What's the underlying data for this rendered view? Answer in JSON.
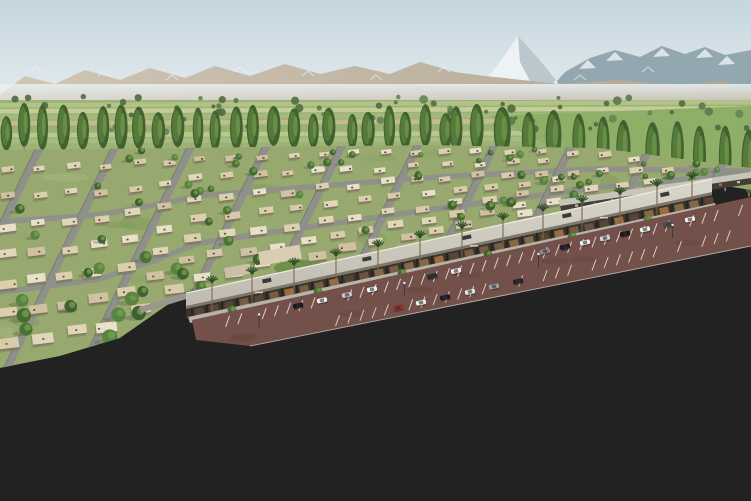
{
  "meta": {
    "title": "Aerial rendering of a master-planned desert community with retail strip",
    "type": "architectural-render",
    "visible_text": []
  },
  "palette": {
    "sky_top": "#c5d6df",
    "sky_bottom": "#e9eff1",
    "mountain_far": "#93a7b1",
    "mountain_far_shadow": "#7f939d",
    "snow": "#edf2f4",
    "mountain_near_light": "#d0c6b6",
    "mountain_near_dark": "#b3a693",
    "haze": "#e9f1f3",
    "field_base": "#9db275",
    "field_strips": [
      "#b4c48c",
      "#c6cf9b",
      "#a4ba7e",
      "#c9bd92",
      "#97b272",
      "#bec990",
      "#a9bd82"
    ],
    "field_bright": "#8fae67",
    "distant_tree": [
      "#5d7b4c",
      "#527044",
      "#67855350",
      "#4f6b42"
    ],
    "poplar_dark": "#426030",
    "poplar_mid": "#567a3a",
    "poplar_light": "#6b9448",
    "trunk": "#9a8a72",
    "lawn": "#97a96f",
    "lawn_var": [
      "#7f9a57",
      "#a8bb80",
      "#8aa263"
    ],
    "street": "#8f8f8b",
    "street_edge": "#63635f",
    "house_walls": [
      "#e2d6ba",
      "#d8cbac",
      "#cfc1a2",
      "#e8e0c8",
      "#dccfae"
    ],
    "house_shadow": "#6b604c",
    "house_opening": "#3a3228",
    "yard_tree": [
      "#3f6030",
      "#4c7038",
      "#5a8242",
      "#476b34"
    ],
    "canopy_light": "#d8d5cc",
    "canopy_dark": "#bfbbb0",
    "canopy_trim": "#eeeae0",
    "fascia": "#7d776c",
    "storefront_band": "#3a342c",
    "glass": [
      "#6a5542",
      "#7a6044",
      "#584836",
      "#8a6c4a",
      "#a0703f"
    ],
    "roof_unit": "#3c3a36",
    "walkway": "#b7b3a8",
    "palm_frond": "#35552a",
    "lot": "#73504a",
    "stall_line": "#eee8de",
    "car_colors": [
      "#f2f2ef",
      "#16161a",
      "#c8c9cb",
      "#4a4e55",
      "#962f28"
    ],
    "umbrella": "#d2662c",
    "island": "#8f8a66",
    "shrub": [
      "#6b7a4a",
      "#8a8a5a",
      "#5d6b42",
      "#b0a278"
    ],
    "road": "#9a9a95",
    "center_line": "#d9a73f",
    "lane_line": "#e3e3dd",
    "crosswalk": "#e2e2dc",
    "sidewalk": "#c8c6be",
    "verge": "#7d8a55",
    "grass": "#8b9157",
    "grass_var": [
      "#9aa36b",
      "#7b8750",
      "#a8ae77",
      "#6f7c49"
    ],
    "shadow_green": "#4c5a36",
    "road_shadow": "#6e6e68",
    "fg_tree_dark": "#3c5a28",
    "fg_tree_mid": "#49702f",
    "fg_tree_light2": "#567f36",
    "fg_tree_hi": [
      "#6f9c41",
      "#7fae4e"
    ],
    "fg_trunk": "#b3a286",
    "sign_red": "#a82f26",
    "sign_green": "#3c6f44"
  },
  "scene": {
    "snow_peak": {
      "x": 518,
      "apex_y": 36
    },
    "mid_poplars_left": {
      "count": 24,
      "x0": 6,
      "x1": 446,
      "base_y": 151,
      "h_min": 34,
      "h_max": 46
    },
    "mid_poplars_right": {
      "count": 13,
      "x0": 455,
      "x1": 748,
      "base_y0": 153,
      "base_y1": 196,
      "h0": 46,
      "h1": 64
    },
    "distant_trees": {
      "count": 70,
      "y0": 96,
      "y1": 132
    },
    "subdivision": {
      "cross_streets": 12,
      "house_rows": 7,
      "yard_trees": 80
    },
    "mall": {
      "x0": 186,
      "y0": 293,
      "x1": 712,
      "y1": 179,
      "slope": -0.2167,
      "palms_x": [
        212,
        252,
        294,
        336,
        378,
        420,
        462,
        503,
        543,
        582,
        620,
        657,
        692
      ],
      "planter_trees_x": [
        232,
        318,
        402,
        488,
        572,
        648
      ],
      "roof_units_x": [
        262,
        362,
        462,
        562,
        660
      ],
      "signs_x": [
        255,
        470,
        600
      ]
    },
    "cafe": {
      "x": 258,
      "y": 252
    },
    "umbrellas": [
      [
        158,
        297
      ],
      [
        171,
        301
      ],
      [
        185,
        307
      ],
      [
        198,
        301
      ],
      [
        207,
        309
      ],
      [
        177,
        313
      ]
    ],
    "plaza_people": [
      [
        162,
        303
      ],
      [
        180,
        309
      ],
      [
        196,
        306
      ],
      [
        208,
        313
      ],
      [
        152,
        300
      ]
    ],
    "walkway_people_x": [
      250,
      300,
      430,
      520,
      610
    ],
    "parking": {
      "row_a_cars": [
        {
          "x": 298,
          "c": "#16161a"
        },
        {
          "x": 322,
          "c": "#f2f2ef"
        },
        {
          "x": 347,
          "c": "#c8c9cb"
        },
        {
          "x": 372,
          "c": "#f4f4f1"
        },
        {
          "x": 432,
          "c": "#2a2c30"
        },
        {
          "x": 456,
          "c": "#f1f1ee"
        },
        {
          "x": 545,
          "c": "#8a8d91"
        },
        {
          "x": 565,
          "c": "#1b1d22"
        },
        {
          "x": 585,
          "c": "#f3f3f0"
        },
        {
          "x": 605,
          "c": "#d6d7d9"
        },
        {
          "x": 625,
          "c": "#16161a"
        },
        {
          "x": 645,
          "c": "#f2f2ef"
        },
        {
          "x": 668,
          "c": "#4a4e55"
        },
        {
          "x": 690,
          "c": "#f0f0ed"
        }
      ],
      "row_b_cars": [
        {
          "x": 398,
          "c": "#962f28"
        },
        {
          "x": 421,
          "c": "#f2f2ef"
        },
        {
          "x": 445,
          "c": "#1a1c20"
        },
        {
          "x": 470,
          "c": "#e8e8e5"
        },
        {
          "x": 494,
          "c": "#9ea1a6"
        },
        {
          "x": 518,
          "c": "#23252a"
        }
      ],
      "light_poles_t": [
        0.12,
        0.38,
        0.62,
        0.86
      ]
    },
    "road_cars": [
      {
        "x": 167,
        "y": 427,
        "r": -13,
        "c": "#f5f5f2",
        "s": 1.15
      },
      {
        "x": 341,
        "y": 362,
        "r": -10,
        "c": "#26262a",
        "s": 1.0
      },
      {
        "x": 683,
        "y": 262,
        "r": -14,
        "c": "#2e3033",
        "s": 0.8
      },
      {
        "x": 668,
        "y": 273,
        "r": -14,
        "c": "#d9d9d6",
        "s": 0.8
      },
      {
        "x": 41,
        "y": 311,
        "r": 68,
        "c": "#1c1c20",
        "s": 0.8
      },
      {
        "x": 33,
        "y": 480,
        "r": 72,
        "c": "#ededea",
        "s": 1.0
      },
      {
        "x": 52,
        "y": 167,
        "r": -12,
        "c": "#f0f0ec",
        "s": 0.55
      },
      {
        "x": 72,
        "y": 199,
        "r": -12,
        "c": "#2a2a2e",
        "s": 0.55
      },
      {
        "x": 252,
        "y": 243,
        "r": -12,
        "c": "#f2f2ee",
        "s": 0.7
      }
    ],
    "foreground_trees": [
      {
        "x": 45,
        "top": 462,
        "base": 512
      },
      {
        "x": 162,
        "top": 428,
        "base": 516
      },
      {
        "x": 252,
        "top": 404,
        "base": 512
      },
      {
        "x": 336,
        "top": 388,
        "base": 506
      },
      {
        "x": 412,
        "top": 380,
        "base": 497
      },
      {
        "x": 472,
        "top": 352,
        "base": 483
      },
      {
        "x": 521,
        "top": 328,
        "base": 452
      },
      {
        "x": 565,
        "top": 314,
        "base": 428
      },
      {
        "x": 608,
        "top": 300,
        "base": 405
      },
      {
        "x": 642,
        "top": 291,
        "base": 391
      },
      {
        "x": 672,
        "top": 283,
        "base": 373
      },
      {
        "x": 700,
        "top": 277,
        "base": 361
      },
      {
        "x": 725,
        "top": 271,
        "base": 351
      },
      {
        "x": 748,
        "top": 267,
        "base": 344
      }
    ],
    "retail_secondary": {
      "x0": 558,
      "y0": 200,
      "x1": 751,
      "y1": 172,
      "accent_colors": [
        "#a83226",
        "#c2702c",
        "#3f7a46",
        "#c9c4ba"
      ]
    },
    "monument_sign": {
      "x": 734,
      "y": 208,
      "w": 13,
      "h": 6
    },
    "green_sign": {
      "x": 702,
      "y": 201,
      "w": 8,
      "h": 4.5
    },
    "roundabout": {
      "cx": 683,
      "cy": 248,
      "rx": 40,
      "ry": 13
    },
    "grass_mottles": 70,
    "counts": {
      "lot_stall_step": 12.5
    }
  }
}
